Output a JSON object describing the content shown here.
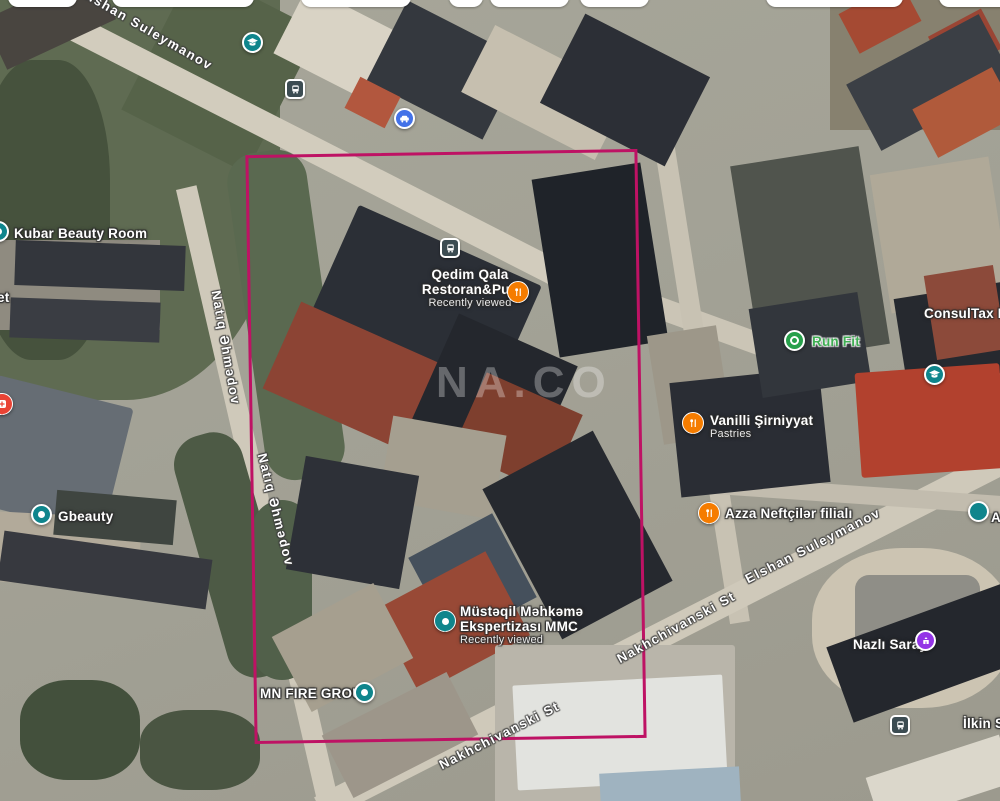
{
  "map_type": "satellite",
  "watermark": "NA.CO",
  "overlay": {
    "selection_rectangle_color": "#be1264"
  },
  "streets": {
    "elshan_suleymanov": "Elshan Suleymanov",
    "natiq_ahmadov": "Natıq Əhmədov",
    "nakhchivanski": "Nakhchivanski St"
  },
  "places": {
    "kubar": {
      "name": "Kubar Beauty Room"
    },
    "qedim": {
      "name_line1": "Qedim Qala",
      "name_line2": "Restoran&Pub",
      "status": "Recently viewed"
    },
    "runfit": {
      "name": "Run Fit"
    },
    "consultax": {
      "name": "ConsulTax MMC"
    },
    "vanilli": {
      "name": "Vanilli Şirniyyat",
      "category": "Pastries"
    },
    "azza": {
      "name": "Azza Neftçilər filialı"
    },
    "gbeauty": {
      "name": "Gbeauty"
    },
    "mustaqil": {
      "name_line1": "Müstəqil Məhkəmə",
      "name_line2": "Ekspertizası MMC",
      "status": "Recently viewed"
    },
    "mnfire": {
      "name": "MN FIRE GROUP"
    },
    "nazli": {
      "name": "Nazlı Saray"
    },
    "ilkin": {
      "name": "İlkin St"
    },
    "left_edge_partial": {
      "name": "et"
    },
    "right_edge_partial": {
      "name": "A"
    }
  },
  "icons": {
    "education": {
      "color": "#0f858c",
      "glyph": "graduation-cap"
    },
    "transit": {
      "color": "#3c4c52",
      "glyph": "bus"
    },
    "car_service": {
      "color": "#4372e8",
      "glyph": "car"
    },
    "restaurant": {
      "color": "#f57c00",
      "glyph": "fork-knife"
    },
    "health": {
      "color": "#e94335",
      "glyph": "cross"
    },
    "visited_poi": {
      "color": "#0f858c",
      "glyph": "dot"
    },
    "fitness": {
      "color": "#27a04b",
      "glyph": "ring"
    },
    "shopping": {
      "color": "#9334e6",
      "glyph": "palace"
    }
  }
}
